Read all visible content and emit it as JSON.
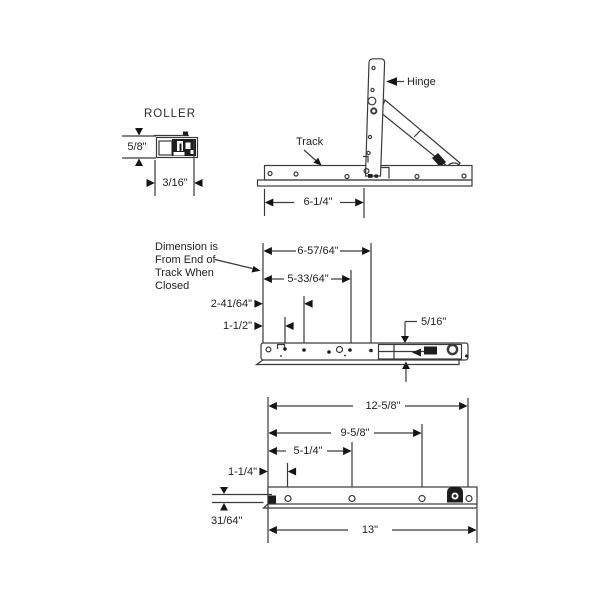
{
  "page": {
    "background": "#ffffff",
    "line_color": "#3a3a3a",
    "arrow_color": "#141414",
    "text_color": "#1f1f1f"
  },
  "roller_detail": {
    "title": "ROLLER",
    "height_dim": "5/8\"",
    "width_dim": "3/16\""
  },
  "top_view": {
    "hinge_label": "Hinge",
    "track_label": "Track",
    "pivot_dim": "6-1/4\""
  },
  "middle_view": {
    "note_lines": [
      "Dimension is",
      "From End of",
      "Track When",
      "Closed"
    ],
    "dim_1": "6-57/64\"",
    "dim_2": "5-33/64\"",
    "dim_3": "2-41/64\"",
    "dim_4": "1-1/2\"",
    "dim_5": "5/16\""
  },
  "bottom_view": {
    "dim_1": "12-5/8\"",
    "dim_2": "9-5/8\"",
    "dim_3": "5-1/4\"",
    "dim_4": "1-1/4\"",
    "dim_5": "31/64\"",
    "dim_6": "13\""
  }
}
